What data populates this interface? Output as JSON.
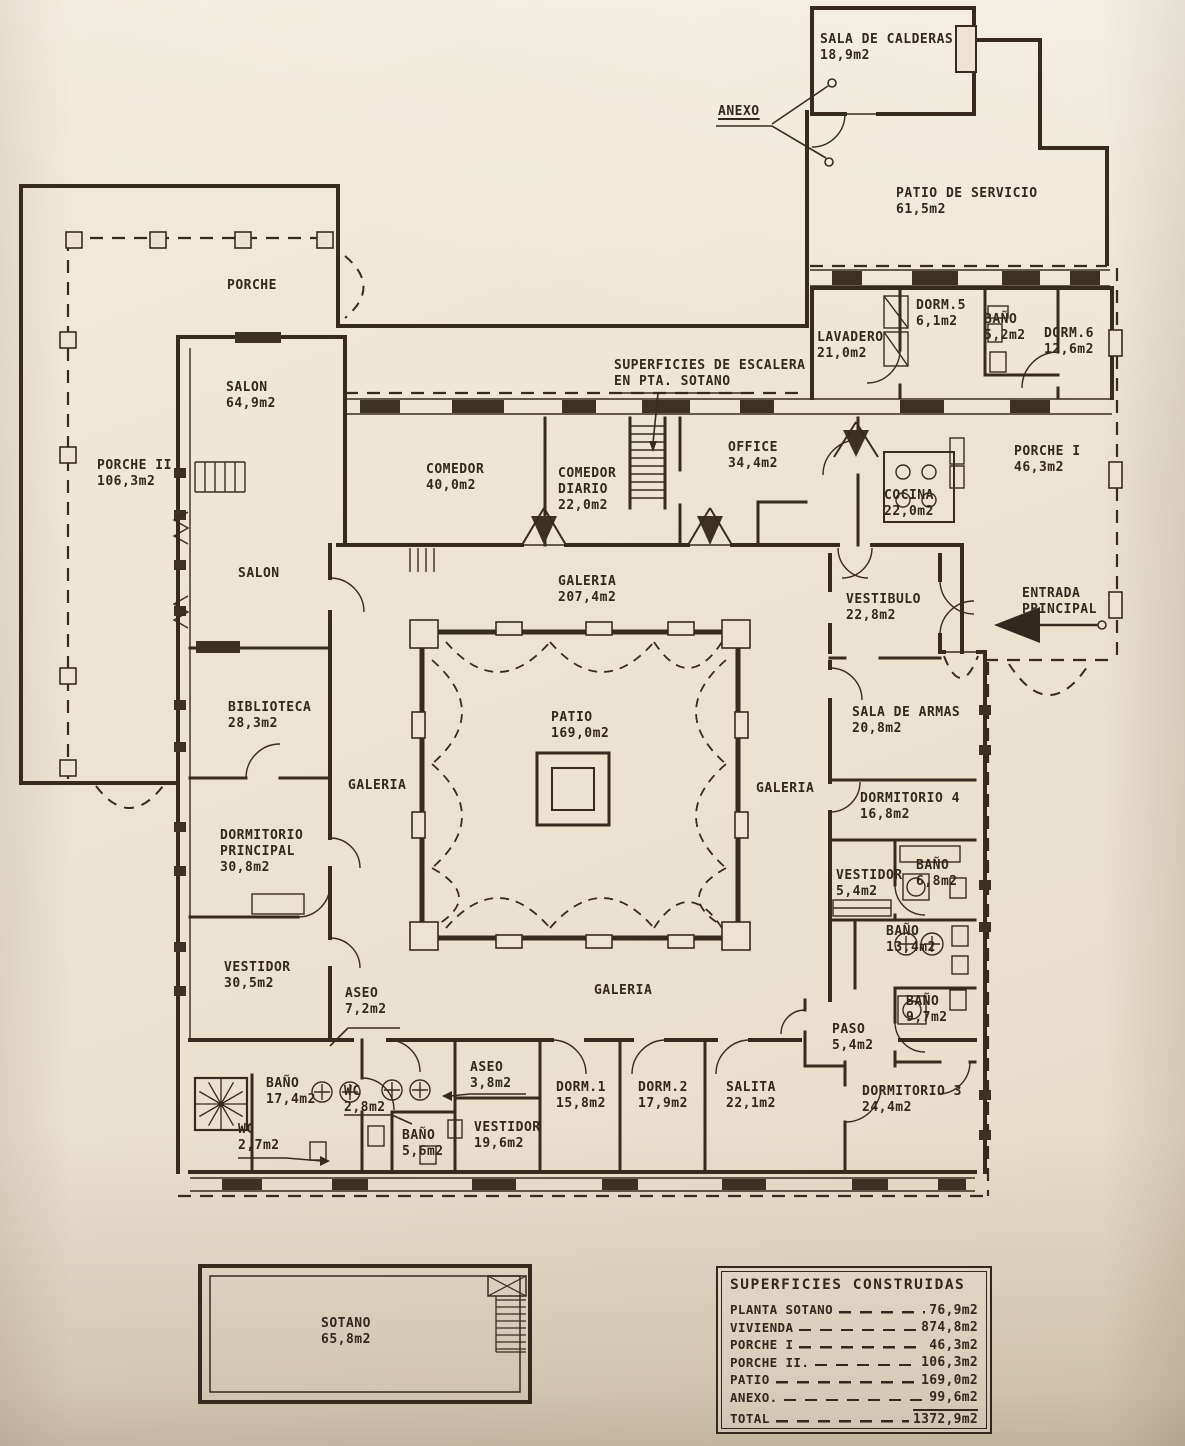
{
  "document": {
    "kind": "architectural floor plan, scanned blueprint",
    "language": "es",
    "ink_color": "#33281d",
    "paper_color": "#ece3d2"
  },
  "rooms": {
    "sala_calderas": "SALA DE CALDERAS\n18,9m2",
    "patio_servicio": "PATIO DE SERVICIO\n61,5m2",
    "porche": "PORCHE",
    "porche2": "PORCHE II\n106,3m2",
    "salon1": "SALON\n64,9m2",
    "salon2": "SALON",
    "lavadero": "LAVADERO\n21,0m2",
    "dorm5": "DORM.5\n6,1m2",
    "bano_5_2": "BAÑO\n5,2m2",
    "dorm6": "DORM.6\n12,6m2",
    "porche1": "PORCHE I\n46,3m2",
    "comedor": "COMEDOR\n40,0m2",
    "comedor_diario": "COMEDOR\nDIARIO\n22,0m2",
    "office": "OFFICE\n34,4m2",
    "cocina": "COCINA\n22,0m2",
    "galeria_norte": "GALERIA\n207,4m2",
    "vestibulo": "VESTIBULO\n22,8m2",
    "biblioteca": "BIBLIOTECA\n28,3m2",
    "patio": "PATIO\n169,0m2",
    "sala_armas": "SALA DE ARMAS\n20,8m2",
    "galeria_oeste": "GALERIA",
    "galeria_este": "GALERIA",
    "galeria_sur": "GALERIA",
    "dormitorio4": "DORMITORIO 4\n16,8m2",
    "dormitorio_principal": "DORMITORIO\nPRINCIPAL\n30,8m2",
    "vestidor_5_4": "VESTIDOR\n5,4m2",
    "bano_6_8": "BAÑO\n6,8m2",
    "bano_13_4": "BAÑO\n13,4m2",
    "vestidor_30_5": "VESTIDOR\n30,5m2",
    "aseo_7_2": "ASEO\n7,2m2",
    "bano_9_7": "BAÑO\n9,7m2",
    "paso": "PASO\n5,4m2",
    "bano_17_4": "BAÑO\n17,4m2",
    "wc_2_8": "WC\n2,8m2",
    "wc_2_7": "WC\n2,7m2",
    "bano_5_6": "BAÑO\n5,6m2",
    "aseo_3_8": "ASEO\n3,8m2",
    "vestidor_19_6": "VESTIDOR\n19,6m2",
    "dorm1": "DORM.1\n15,8m2",
    "dorm2": "DORM.2\n17,9m2",
    "salita": "SALITA\n22,1m2",
    "dormitorio3": "DORMITORIO 3\n24,4m2",
    "sotano": "SOTANO\n65,8m2"
  },
  "annotations": {
    "anexo": "ANEXO",
    "escalera": "SUPERFICIES DE ESCALERA\nEN PTA. SOTANO",
    "entrada": "ENTRADA\nPRINCIPAL"
  },
  "legend": {
    "title": "SUPERFICIES CONSTRUIDAS",
    "rows": [
      {
        "label": "PLANTA SOTANO",
        "value": "76,9m2"
      },
      {
        "label": "VIVIENDA",
        "value": "874,8m2"
      },
      {
        "label": "PORCHE I",
        "value": "46,3m2"
      },
      {
        "label": "PORCHE II.",
        "value": "106,3m2"
      },
      {
        "label": "PATIO",
        "value": "169,0m2"
      },
      {
        "label": "ANEXO.",
        "value": "99,6m2"
      },
      {
        "label": "TOTAL",
        "value": "1372,9m2"
      }
    ]
  }
}
